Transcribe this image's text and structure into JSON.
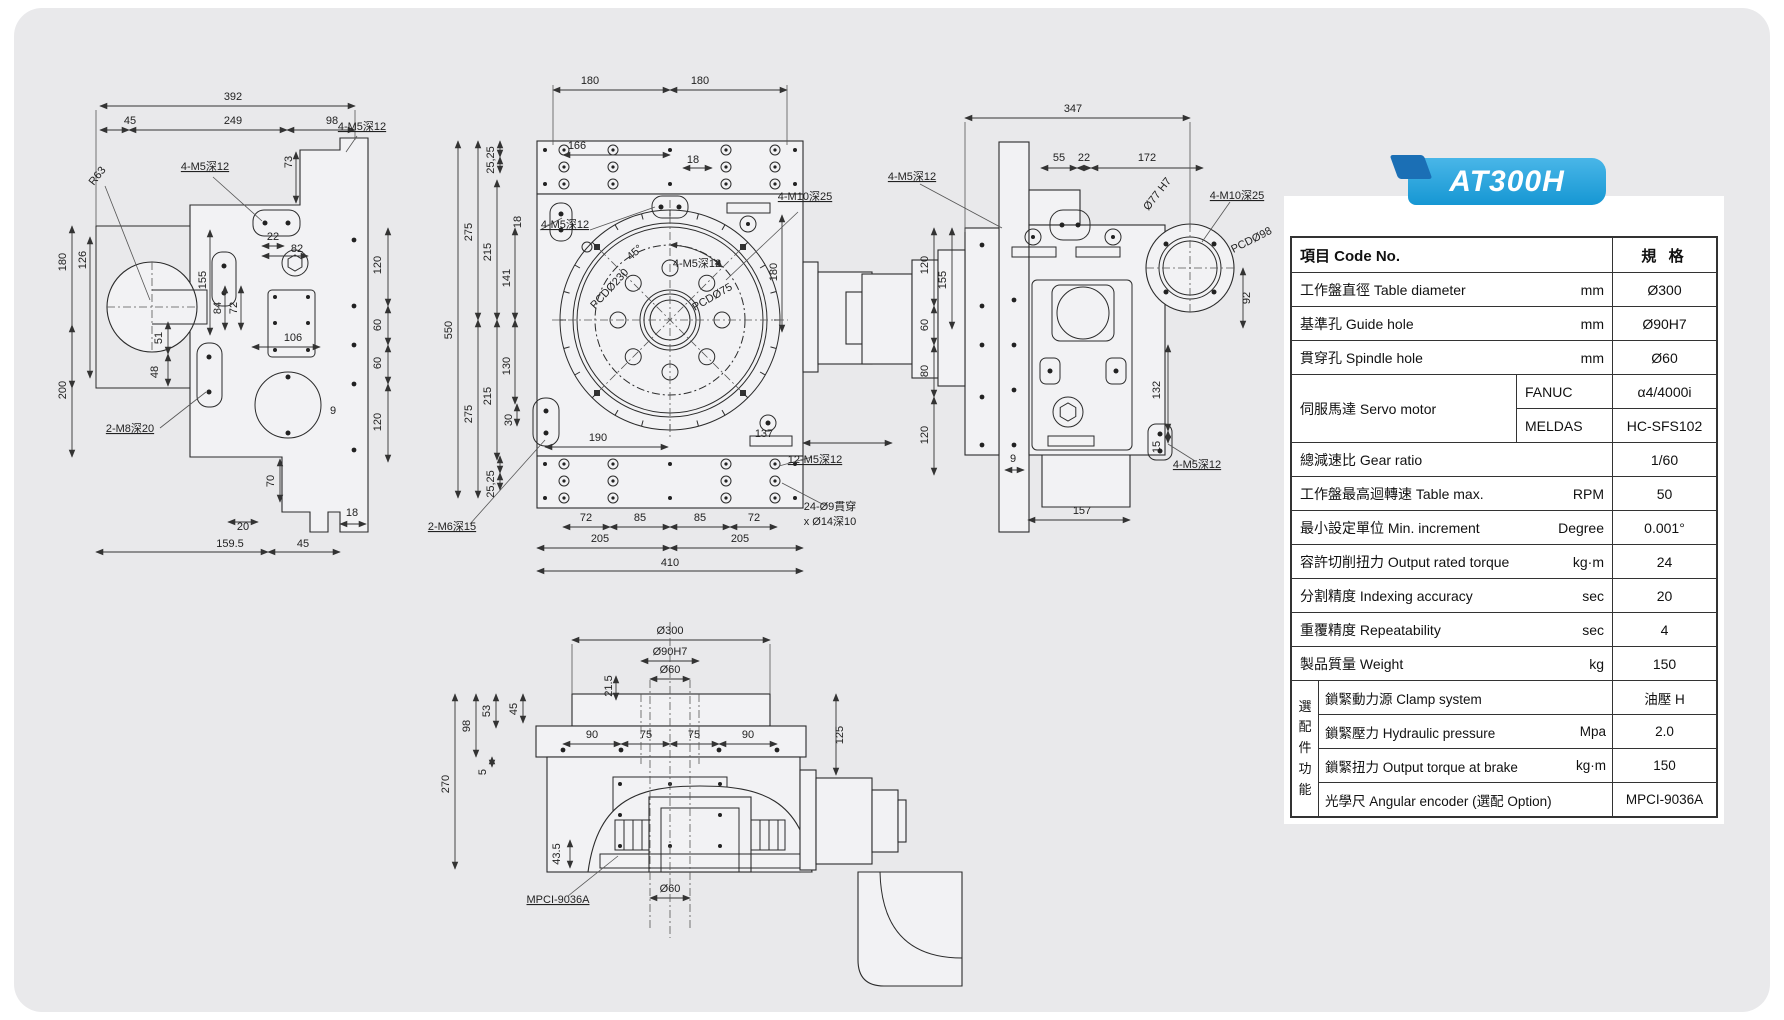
{
  "product": {
    "model": "AT300H"
  },
  "colors": {
    "banner_blue": "#29a7e0",
    "banner_dark_blue": "#1b6fb5",
    "card_gray": "#e9e9eb",
    "line_color": "#2b2b2b"
  },
  "spec_table": {
    "header": {
      "item": "項目 Code No.",
      "spec": "規 格"
    },
    "rows": [
      {
        "label": "工作盤直徑 Table diameter",
        "unit": "mm",
        "value": "Ø300"
      },
      {
        "label": "基準孔 Guide hole",
        "unit": "mm",
        "value": "Ø90H7"
      },
      {
        "label": "貫穿孔 Spindle hole",
        "unit": "mm",
        "value": "Ø60"
      }
    ],
    "servo_row": {
      "label": "伺服馬達 Servo motor",
      "subs": [
        {
          "brand": "FANUC",
          "value": "α4/4000i"
        },
        {
          "brand": "MELDAS",
          "value": "HC-SFS102"
        }
      ]
    },
    "rows_after": [
      {
        "label": "總減速比 Gear ratio",
        "unit": "",
        "value": "1/60"
      },
      {
        "label": "工作盤最高迴轉速 Table max.",
        "unit": "RPM",
        "value": "50"
      },
      {
        "label": "最小設定單位 Min. increment",
        "unit": "Degree",
        "value": "0.001°"
      },
      {
        "label": "容許切削扭力 Output rated torque",
        "unit": "kg·m",
        "value": "24"
      },
      {
        "label": "分割精度 Indexing accuracy",
        "unit": "sec",
        "value": "20"
      },
      {
        "label": "重覆精度 Repeatability",
        "unit": "sec",
        "value": "4"
      },
      {
        "label": "製品質量 Weight",
        "unit": "kg",
        "value": "150"
      }
    ],
    "option_group": {
      "label": "選配件功能",
      "rows": [
        {
          "label": "鎖緊動力源 Clamp system",
          "unit": "",
          "value": "油壓 H"
        },
        {
          "label": "鎖緊壓力 Hydraulic pressure",
          "unit": "Mpa",
          "value": "2.0"
        },
        {
          "label": "鎖緊扭力 Output torque at brake",
          "unit": "kg·m",
          "value": "150"
        },
        {
          "label": "光學尺 Angular encoder (選配 Option)",
          "unit": "",
          "value": "MPCI-9036A"
        }
      ]
    }
  },
  "drawings": {
    "left_view_labels": [
      "392",
      "45",
      "249",
      "98",
      "R63",
      "4-M5深12",
      "4-M5深12",
      "73",
      "22",
      "82",
      "120",
      "60",
      "60",
      "120",
      "180",
      "126",
      "155",
      "84",
      "72",
      "106",
      "51",
      "48",
      "200",
      "2-M8深20",
      "9",
      "70",
      "20",
      "18",
      "159.5",
      "45"
    ],
    "front_view_labels": [
      "180",
      "180",
      "166",
      "4-M5深12",
      "18",
      "25,25",
      "275",
      "215",
      "141",
      "18",
      "45°",
      "4-M5深12",
      "PCDØ230",
      "PCDØ75",
      "180",
      "4-M10深25",
      "550",
      "130",
      "215",
      "275",
      "30",
      "190",
      "25,25",
      "137",
      "2-M6深15",
      "72",
      "85",
      "85",
      "72",
      "205",
      "205",
      "410",
      "12-M5深12",
      "24-Ø9貫穿",
      "x Ø14深10"
    ],
    "right_view_labels": [
      "347",
      "55",
      "22",
      "172",
      "4-M5深12",
      "Ø77 H7",
      "4-M10深25",
      "PCDØ98",
      "120",
      "155",
      "60",
      "80",
      "120",
      "92",
      "132",
      "15",
      "4-M5深12",
      "9",
      "157"
    ],
    "bottom_view_labels": [
      "Ø300",
      "Ø90H7",
      "Ø60",
      "21.5",
      "53",
      "45",
      "98",
      "5",
      "270",
      "90",
      "75",
      "75",
      "90",
      "125",
      "43.5",
      "MPCI-9036A",
      "Ø60"
    ]
  }
}
